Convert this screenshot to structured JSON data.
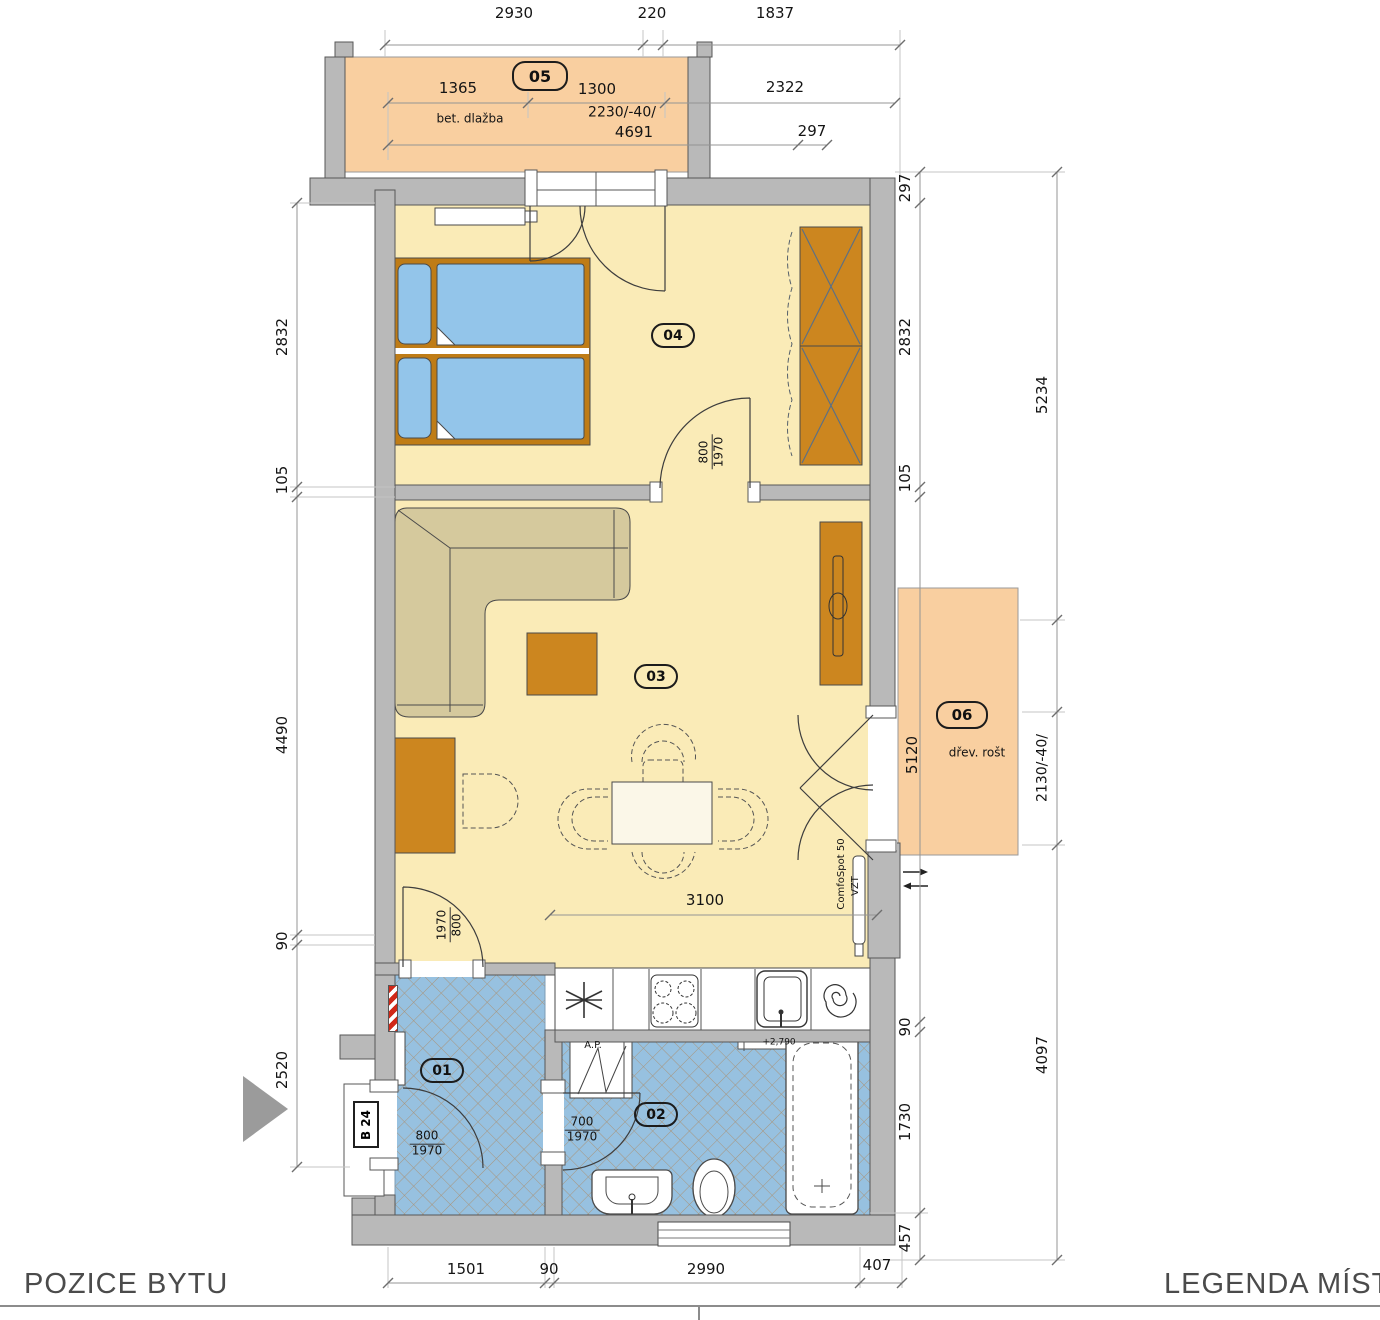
{
  "footer": {
    "left": "POZICE BYTU",
    "right": "LEGENDA MÍSTN"
  },
  "room_badges": {
    "hall": "01",
    "bath": "02",
    "living": "03",
    "bedroom": "04",
    "balcony_top": "05",
    "balcony_side": "06"
  },
  "dims_top": [
    "2930",
    "220",
    "1837"
  ],
  "balcony_top": {
    "w1": "1365",
    "w2": "1300",
    "right": "2322",
    "floor": "bet. dlažba",
    "level": "2230/-40/",
    "total": "4691",
    "offset": "297"
  },
  "dims_left": [
    "2832",
    "105",
    "4490",
    "90",
    "2520"
  ],
  "dims_right_inner": [
    "297",
    "2832",
    "105",
    "5120",
    "90",
    "1730",
    "457"
  ],
  "dims_right_outer": {
    "top": "5234",
    "mid": "2130/-40/",
    "bottom": "4097"
  },
  "dims_bottom": [
    "1501",
    "90",
    "2990",
    "407"
  ],
  "living": {
    "width_dim": "3100",
    "vent_unit": "ComfoSpot 50",
    "vent_system": "VZT"
  },
  "balcony_side": {
    "floor": "dřev. rošt"
  },
  "doors": {
    "bedroom": {
      "w": "800",
      "h": "1970"
    },
    "living_hall": {
      "h": "1970",
      "w": "800"
    },
    "entry": {
      "w": "800",
      "h": "1970"
    },
    "bath": {
      "w": "700",
      "h": "1970"
    }
  },
  "labels": {
    "apartment": "B 24",
    "washer": "A.P.",
    "bath_level": "+2,790"
  },
  "palette": {
    "wall": "#B9B9B9",
    "floor": "#FAEBB7",
    "balcony": "#F9CFA0",
    "tiles": "#92BEDD",
    "furniture": "#CC861F",
    "bed": "#93C5EA"
  }
}
